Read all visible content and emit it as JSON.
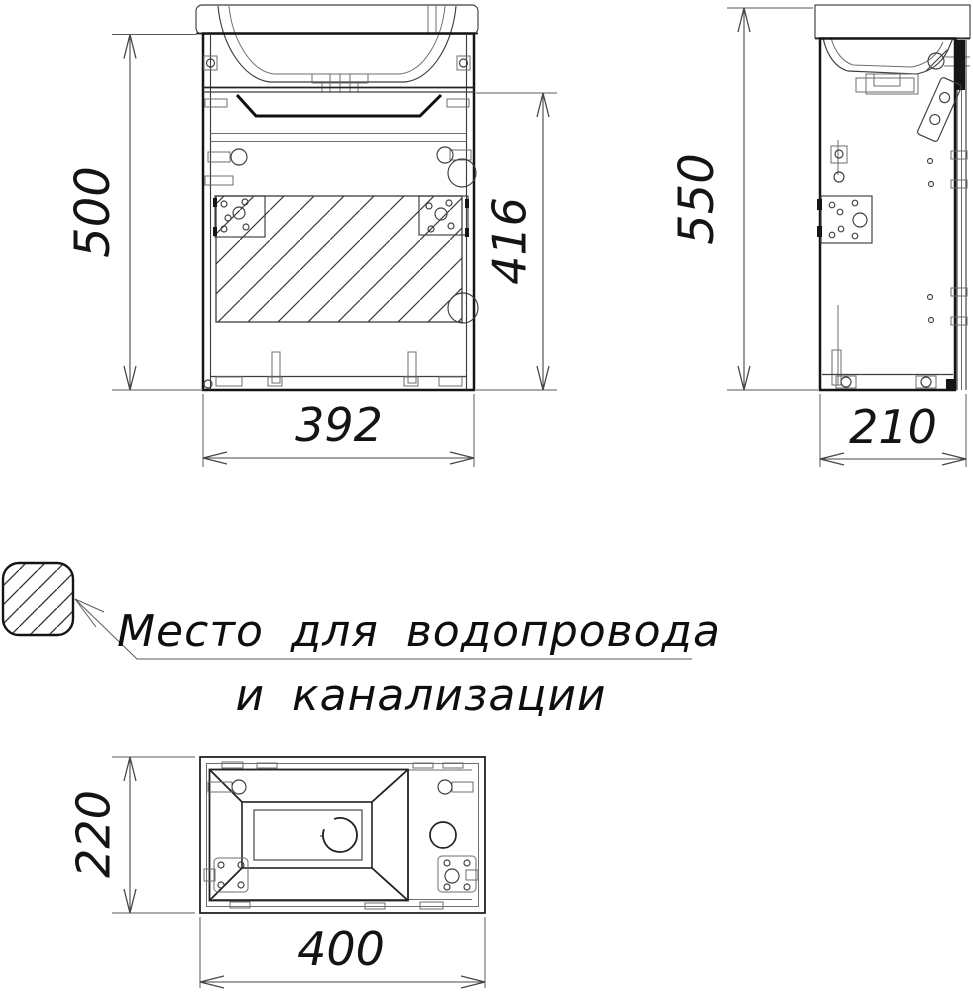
{
  "page": {
    "background": "#ffffff"
  },
  "colors": {
    "outline": "#141414",
    "thin_line": "#3d3d3d",
    "dimension_line": "#474747",
    "hatch_line": "#3a3a3a"
  },
  "views": {
    "front": {
      "dim_height": "500",
      "dim_opening_height": "416",
      "dim_width": "392"
    },
    "side": {
      "dim_height": "550",
      "dim_depth": "210"
    },
    "top": {
      "dim_depth": "220",
      "dim_width": "400"
    }
  },
  "legend": {
    "symbol": "hatched-area-icon",
    "note_line1": "Место для водопровода",
    "note_line2": "и канализации"
  }
}
